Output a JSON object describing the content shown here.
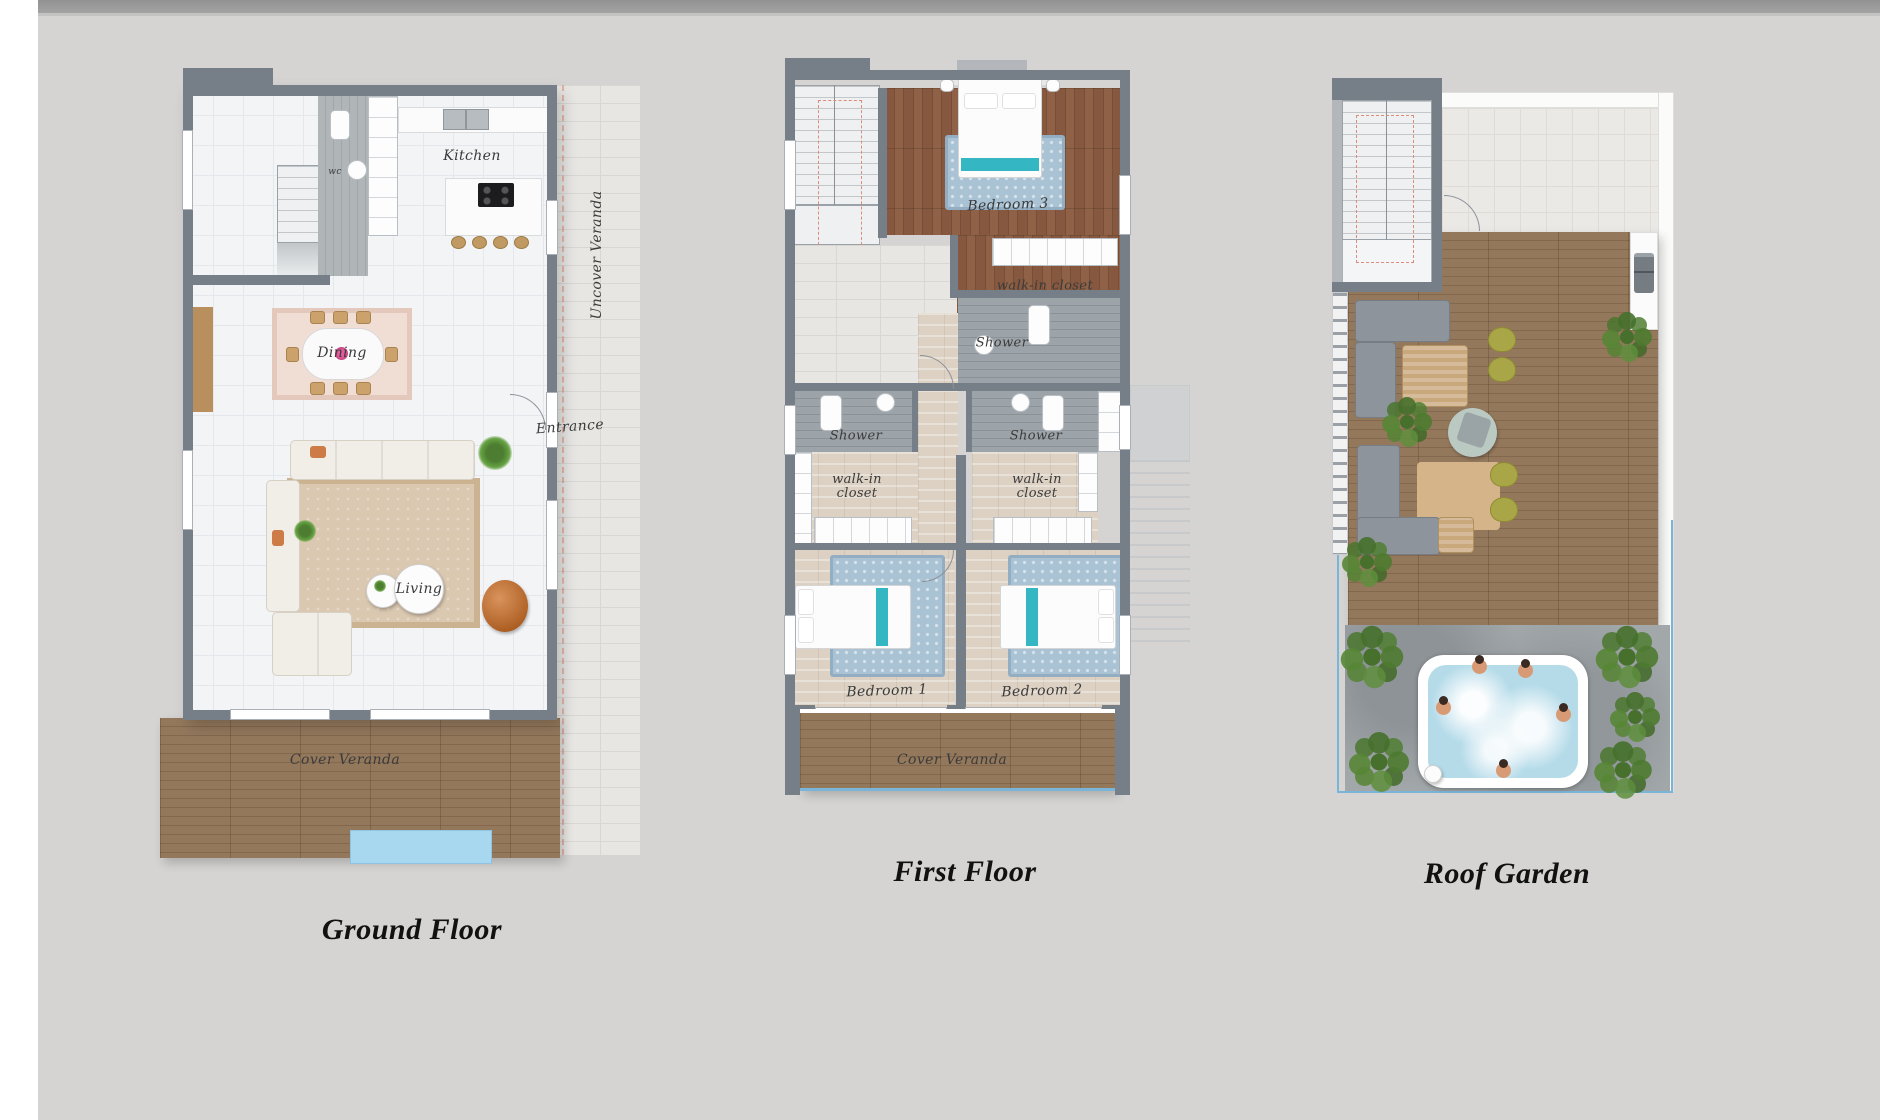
{
  "sheet": {
    "background": "#d5d4d2",
    "top_bar_color": "#9a9a9a",
    "left_margin_color": "#ffffff"
  },
  "plans": [
    {
      "name": "ground-floor",
      "caption": "Ground Floor",
      "labels": {
        "kitchen": "Kitchen",
        "wc": "wc",
        "dining": "Dining",
        "entrance": "Entrance",
        "living": "Living",
        "cover_veranda": "Cover Veranda",
        "uncover_veranda": "Uncover Veranda"
      }
    },
    {
      "name": "first-floor",
      "caption": "First Floor",
      "labels": {
        "bedroom3": "Bedroom 3",
        "walk_in_closet_top": "walk-in closet",
        "shower_top": "Shower",
        "shower_left": "Shower",
        "shower_right": "Shower",
        "walk_in_closet_left": "walk-in closet",
        "walk_in_closet_right": "walk-in closet",
        "bedroom1": "Bedroom 1",
        "bedroom2": "Bedroom 2",
        "cover_veranda": "Cover Veranda"
      }
    },
    {
      "name": "roof-garden",
      "caption": "Roof Garden",
      "labels": {}
    }
  ],
  "palette": {
    "wall": "#767e87",
    "wood_deck": "#8a7057",
    "dark_wood": "#835c44",
    "gray_tile": "#979ea3",
    "travertine": "#dcd1c3",
    "stone": "#e7e6e3",
    "pool": "#a8d8f0",
    "jacuzzi_water": "#b5dbe9",
    "rug_blue": "#a9c2d4",
    "teal_accent": "#35b6c3",
    "olive_chair": "#a9a647",
    "plant_green": "#4c7d30",
    "concrete": "#a2a7aa",
    "caption_color": "#111111"
  }
}
